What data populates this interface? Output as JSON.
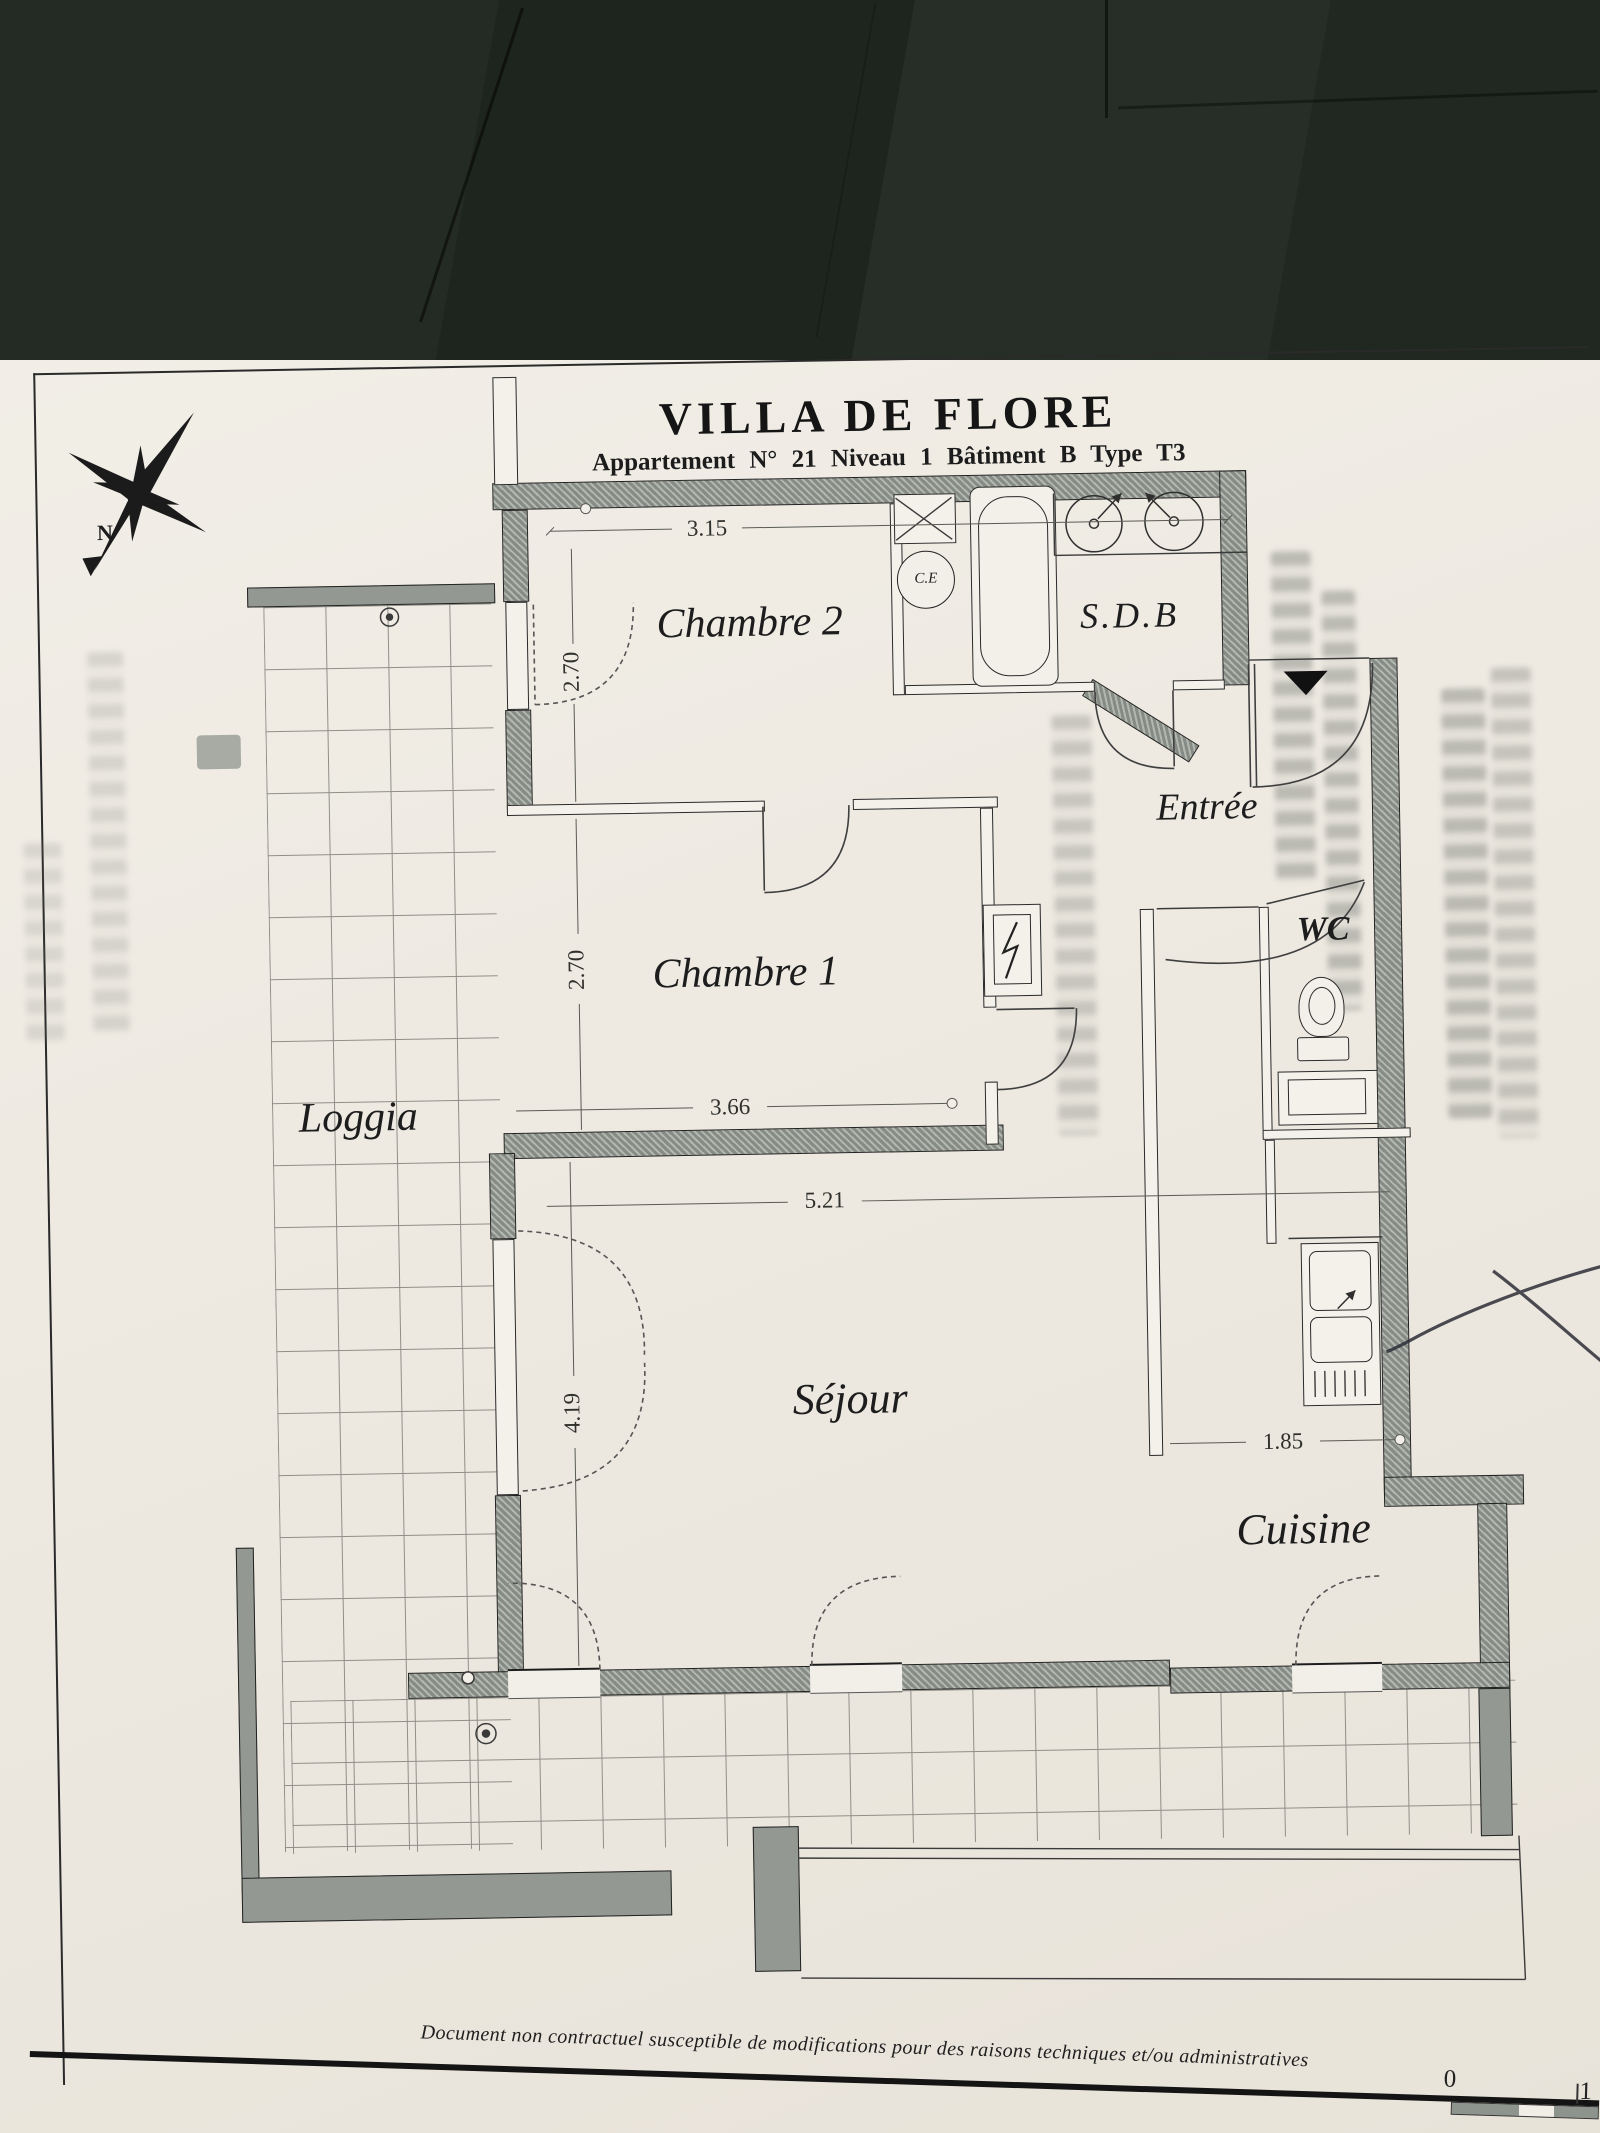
{
  "document": {
    "title": "VILLA DE FLORE",
    "subtitle": "Appartement N° 21 Niveau 1 Bâtiment B Type T3",
    "footer_note": "Document non contractuel susceptible de modifications pour des raisons techniques et/ou administratives"
  },
  "compass": {
    "north_label": "N"
  },
  "rooms": {
    "chambre2": {
      "label": "Chambre 2"
    },
    "sdb": {
      "label": "S.D.B"
    },
    "entree": {
      "label": "Entrée"
    },
    "wc": {
      "label": "WC"
    },
    "chambre1": {
      "label": "Chambre 1"
    },
    "loggia": {
      "label": "Loggia"
    },
    "sejour": {
      "label": "Séjour"
    },
    "cuisine": {
      "label": "Cuisine"
    }
  },
  "fixtures": {
    "water_heater_label": "C.E"
  },
  "dimensions": {
    "chambre2_width": "3.15",
    "chambre2_depth": "2.70",
    "chambre1_depth": "2.70",
    "chambre1_width": "3.66",
    "sejour_width": "5.21",
    "sejour_depth": "4.19",
    "cuisine_width": "1.85"
  },
  "scale_bar": {
    "start": "0",
    "end": "1"
  },
  "colors": {
    "paper": "#eeeae2",
    "wall_hatch": "#868c85",
    "dark_tiles": "#222a23",
    "ink": "#1b1b1b",
    "pen_mark": "#2e2e38"
  }
}
